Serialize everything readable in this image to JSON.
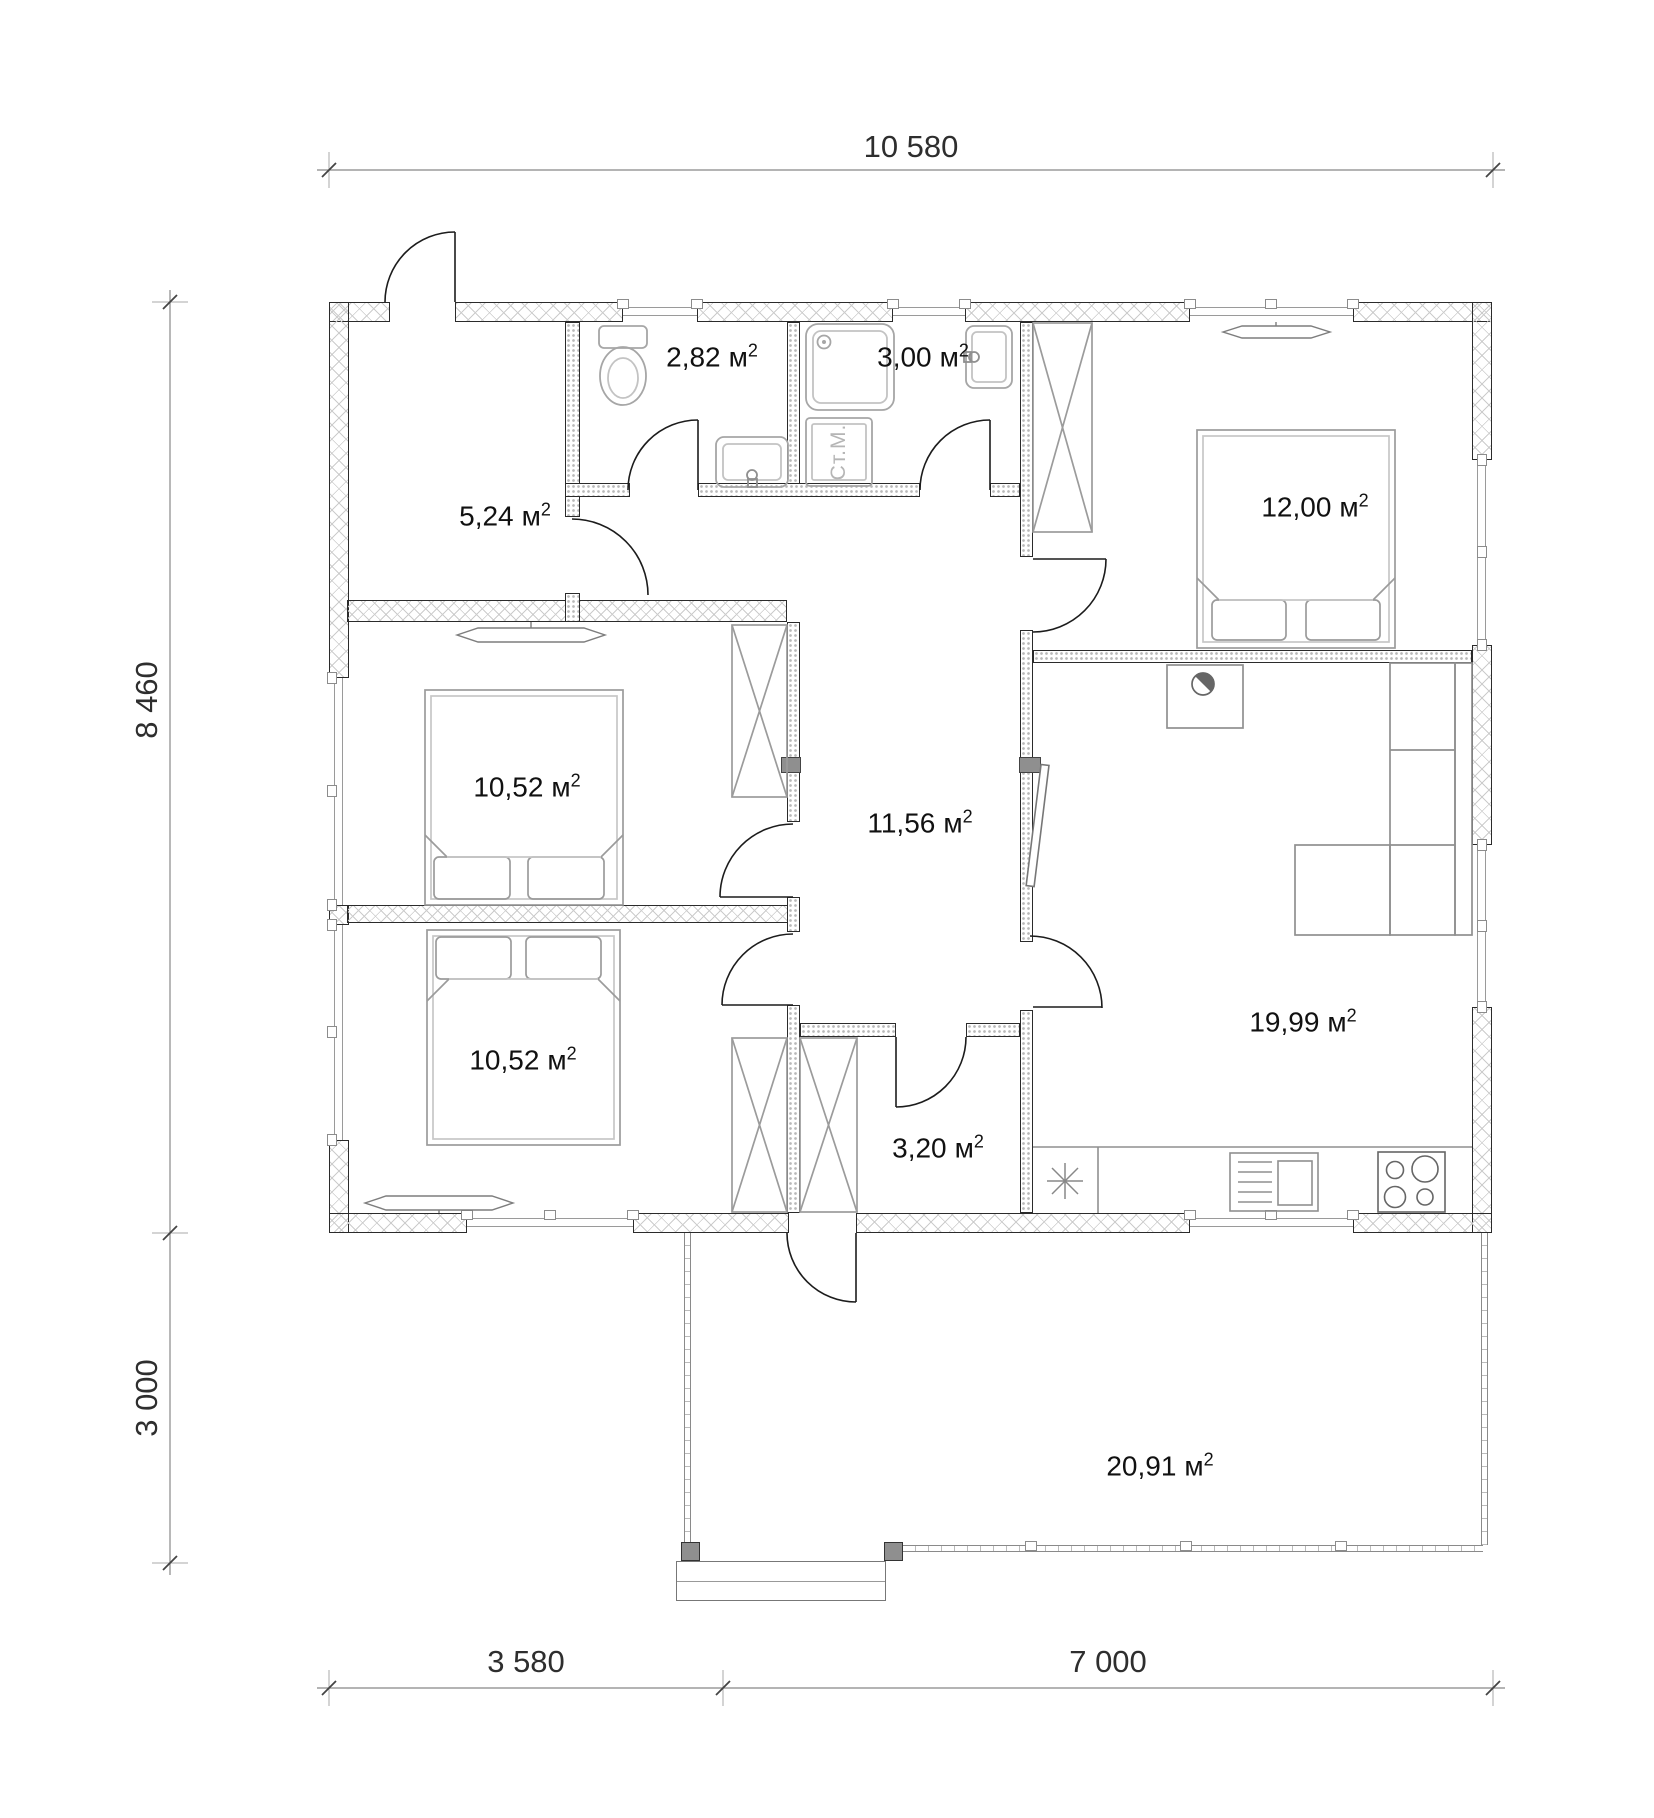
{
  "title": "house-floor-plan",
  "dimensions": {
    "top_width": "10 580",
    "left_house_height": "8 460",
    "left_terrace_height": "3 000",
    "bottom_left": "3 580",
    "bottom_right": "7 000"
  },
  "rooms": {
    "hall": {
      "value": "5,24",
      "unit": "м",
      "sup": "2"
    },
    "wc": {
      "value": "2,82",
      "unit": "м",
      "sup": "2"
    },
    "shower": {
      "value": "3,00",
      "unit": "м",
      "sup": "2"
    },
    "bedroom_right": {
      "value": "12,00",
      "unit": "м",
      "sup": "2"
    },
    "bedroom_upper": {
      "value": "10,52",
      "unit": "м",
      "sup": "2"
    },
    "corridor": {
      "value": "11,56",
      "unit": "м",
      "sup": "2"
    },
    "bedroom_lower": {
      "value": "10,52",
      "unit": "м",
      "sup": "2"
    },
    "living_kitchen": {
      "value": "19,99",
      "unit": "м",
      "sup": "2"
    },
    "storage": {
      "value": "3,20",
      "unit": "м",
      "sup": "2"
    },
    "terrace": {
      "value": "20,91",
      "unit": "м",
      "sup": "2"
    }
  },
  "labels": {
    "washing_machine": "Ст.М."
  },
  "colors": {
    "wall_line": "#2b2b2b",
    "hatch": "#cccccc",
    "furniture": "#9b9b9b",
    "fixture": "#a6a6a6",
    "door": "#1c1c1c",
    "dimension": "#444444",
    "text": "#111111"
  }
}
